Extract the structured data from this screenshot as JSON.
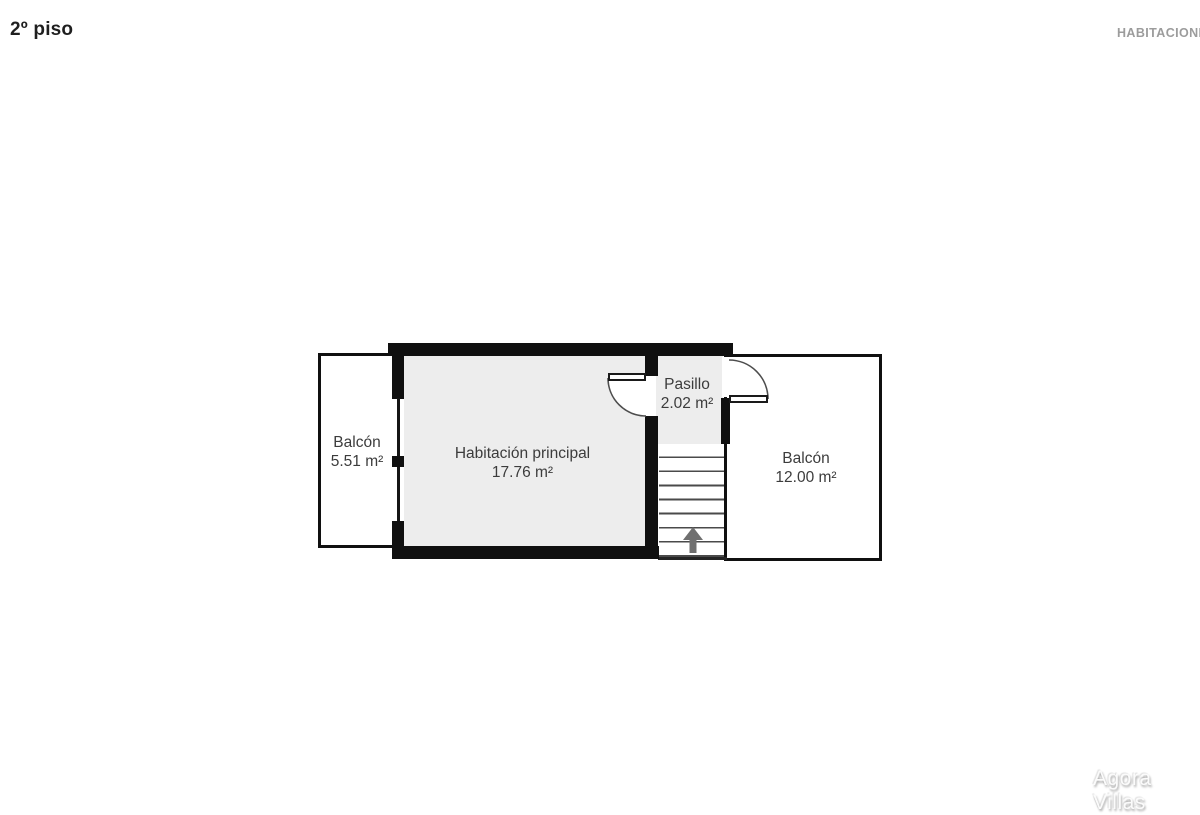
{
  "header": {
    "title": "2º piso",
    "right_label": "HABITACIONES"
  },
  "floorplan": {
    "rooms": [
      {
        "name": "Balcón",
        "area": "5.51 m²"
      },
      {
        "name": "Habitación principal",
        "area": "17.76 m²"
      },
      {
        "name": "Pasillo",
        "area": "2.02 m²"
      },
      {
        "name": "Balcón",
        "area": "12.00 m²"
      }
    ],
    "stairs": {
      "direction": "up",
      "steps": 9
    },
    "colors": {
      "wall": "#101010",
      "room_fill": "#ededed",
      "outdoor_fill": "#ffffff",
      "label_text": "#3c3c3c",
      "stair_arrow": "#6f6f6f"
    }
  },
  "watermark": "Agora Villas"
}
